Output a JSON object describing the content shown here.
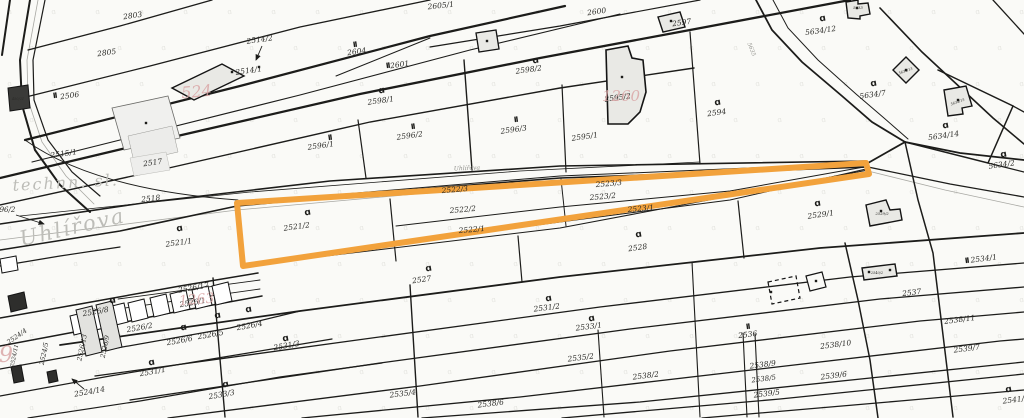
{
  "map": {
    "street_labels": [
      {
        "text": "Uhlířova",
        "x": 74,
        "y": 234,
        "size": 21,
        "rot": -13,
        "style": "major"
      },
      {
        "text": "technn. sl.",
        "x": 66,
        "y": 188,
        "size": 16,
        "rot": -3,
        "style": "major"
      },
      {
        "text": "Uhlířova",
        "x": 467,
        "y": 170,
        "size": 6,
        "rot": -2,
        "style": "minor"
      },
      {
        "text": "5635",
        "x": 750,
        "y": 50,
        "size": 5.5,
        "rot": 68,
        "style": "minor"
      }
    ],
    "house_numbers": [
      {
        "text": "524",
        "x": 197,
        "y": 97,
        "size": 16,
        "rot": -5
      },
      {
        "text": "1260",
        "x": 621,
        "y": 101,
        "size": 15,
        "rot": 0
      },
      {
        "text": "1263",
        "x": 197,
        "y": 304,
        "size": 14,
        "rot": -5
      },
      {
        "text": "9",
        "x": 6,
        "y": 362,
        "size": 22,
        "rot": 0
      }
    ],
    "parcel_labels": [
      {
        "t": "2803",
        "x": 133,
        "y": 18,
        "r": -8
      },
      {
        "t": "2805",
        "x": 107,
        "y": 55,
        "r": -8
      },
      {
        "t": "2506",
        "x": 70,
        "y": 98,
        "r": -8
      },
      {
        "t": "2514/2",
        "x": 260,
        "y": 42,
        "r": -8
      },
      {
        "t": "2514/1",
        "x": 249,
        "y": 73,
        "r": -8
      },
      {
        "t": "2515/1",
        "x": 64,
        "y": 156,
        "r": -8
      },
      {
        "t": "2517",
        "x": 153,
        "y": 165,
        "r": -8
      },
      {
        "t": "2518",
        "x": 151,
        "y": 201,
        "r": -6
      },
      {
        "t": "2605/1",
        "x": 441,
        "y": 8,
        "r": -6
      },
      {
        "t": "2600",
        "x": 597,
        "y": 14,
        "r": -8
      },
      {
        "t": "2597",
        "x": 682,
        "y": 25,
        "r": -8
      },
      {
        "t": "2604",
        "x": 357,
        "y": 54,
        "r": -8
      },
      {
        "t": "2601",
        "x": 400,
        "y": 67,
        "r": -8
      },
      {
        "t": "2598/2",
        "x": 529,
        "y": 72,
        "r": -8
      },
      {
        "t": "2598/1",
        "x": 381,
        "y": 103,
        "r": -8
      },
      {
        "t": "2595/2",
        "x": 618,
        "y": 100,
        "r": -8
      },
      {
        "t": "2595/1",
        "x": 585,
        "y": 139,
        "r": -8
      },
      {
        "t": "2596/3",
        "x": 514,
        "y": 132,
        "r": -8
      },
      {
        "t": "2596/2",
        "x": 410,
        "y": 138,
        "r": -8
      },
      {
        "t": "2596/1",
        "x": 321,
        "y": 148,
        "r": -8
      },
      {
        "t": "2594",
        "x": 717,
        "y": 115,
        "r": -8
      },
      {
        "t": "5634/12",
        "x": 821,
        "y": 33,
        "r": -8
      },
      {
        "t": "5634/7",
        "x": 873,
        "y": 97,
        "r": -8
      },
      {
        "t": "5634/14",
        "x": 944,
        "y": 138,
        "r": -8
      },
      {
        "t": "5634/2",
        "x": 1002,
        "y": 167,
        "r": -8
      },
      {
        "t": "2521/1",
        "x": 179,
        "y": 245,
        "r": -8
      },
      {
        "t": "2521/2",
        "x": 297,
        "y": 229,
        "r": -8
      },
      {
        "t": "2522/3",
        "x": 455,
        "y": 192,
        "r": -5
      },
      {
        "t": "2522/2",
        "x": 463,
        "y": 212,
        "r": -5
      },
      {
        "t": "2522/1",
        "x": 472,
        "y": 232,
        "r": -5
      },
      {
        "t": "2523/3",
        "x": 609,
        "y": 186,
        "r": -5
      },
      {
        "t": "2523/2",
        "x": 603,
        "y": 199,
        "r": -5
      },
      {
        "t": "2523/1",
        "x": 641,
        "y": 211,
        "r": -5
      },
      {
        "t": "2529/1",
        "x": 821,
        "y": 217,
        "r": -8
      },
      {
        "t": "2528",
        "x": 638,
        "y": 250,
        "r": -8
      },
      {
        "t": "2527",
        "x": 422,
        "y": 282,
        "r": -8
      },
      {
        "t": "2526/17",
        "x": 194,
        "y": 290,
        "r": -10
      },
      {
        "t": "2526/1",
        "x": 193,
        "y": 305,
        "r": -10
      },
      {
        "t": "2526/8",
        "x": 96,
        "y": 314,
        "r": -10
      },
      {
        "t": "2526/2",
        "x": 140,
        "y": 330,
        "r": -10
      },
      {
        "t": "2526/6",
        "x": 180,
        "y": 343,
        "r": -10
      },
      {
        "t": "2526/5",
        "x": 211,
        "y": 337,
        "r": -10
      },
      {
        "t": "2526/4",
        "x": 250,
        "y": 328,
        "r": -10
      },
      {
        "t": "2526/13",
        "x": 84,
        "y": 348,
        "r": -78,
        "s": 6.5
      },
      {
        "t": "2526/9",
        "x": 107,
        "y": 347,
        "r": -78,
        "s": 6.5
      },
      {
        "t": "2524/4",
        "x": 18,
        "y": 338,
        "r": -35,
        "s": 6.5
      },
      {
        "t": "2524/11",
        "x": 16,
        "y": 356,
        "r": -78,
        "s": 5.5
      },
      {
        "t": "2524/5",
        "x": 46,
        "y": 354,
        "r": -78,
        "s": 6.5
      },
      {
        "t": "2524/14",
        "x": 90,
        "y": 394,
        "r": -10
      },
      {
        "t": "2531/1",
        "x": 153,
        "y": 374,
        "r": -10
      },
      {
        "t": "2531/3",
        "x": 287,
        "y": 348,
        "r": -10
      },
      {
        "t": "2533/3",
        "x": 222,
        "y": 397,
        "r": -10
      },
      {
        "t": "2531/2",
        "x": 547,
        "y": 310,
        "r": -7
      },
      {
        "t": "2533/1",
        "x": 589,
        "y": 329,
        "r": -7
      },
      {
        "t": "2535/4",
        "x": 403,
        "y": 396,
        "r": -7
      },
      {
        "t": "2535/2",
        "x": 581,
        "y": 360,
        "r": -7
      },
      {
        "t": "2538/6",
        "x": 491,
        "y": 406,
        "r": -7
      },
      {
        "t": "2538/2",
        "x": 646,
        "y": 378,
        "r": -7
      },
      {
        "t": "2536",
        "x": 748,
        "y": 337,
        "r": -7
      },
      {
        "t": "2537",
        "x": 912,
        "y": 295,
        "r": -7
      },
      {
        "t": "2534/1",
        "x": 984,
        "y": 261,
        "r": -7
      },
      {
        "t": "2538/11",
        "x": 960,
        "y": 322,
        "r": -7
      },
      {
        "t": "2538/10",
        "x": 836,
        "y": 347,
        "r": -7
      },
      {
        "t": "2539/7",
        "x": 967,
        "y": 351,
        "r": -7
      },
      {
        "t": "2538/9",
        "x": 763,
        "y": 367,
        "r": -7
      },
      {
        "t": "2538/5",
        "x": 764,
        "y": 381,
        "r": -7,
        "s": 7
      },
      {
        "t": "2539/6",
        "x": 834,
        "y": 378,
        "r": -7
      },
      {
        "t": "2539/5",
        "x": 767,
        "y": 396,
        "r": -7
      },
      {
        "t": "2541/2",
        "x": 1016,
        "y": 402,
        "r": -7
      },
      {
        "t": "2596/2",
        "x": 3,
        "y": 212,
        "r": 0,
        "s": 7
      }
    ],
    "building_labels": [
      {
        "t": "5633",
        "x": 858,
        "y": 9,
        "s": 3.8
      },
      {
        "t": "5634/13",
        "x": 906,
        "y": 72,
        "s": 3.5,
        "r": -20
      },
      {
        "t": "5634/15",
        "x": 958,
        "y": 103,
        "s": 3.5,
        "r": -20
      },
      {
        "t": "2529/2",
        "x": 882,
        "y": 215,
        "s": 3.8
      },
      {
        "t": "2540/2",
        "x": 877,
        "y": 274,
        "s": 3.5
      },
      {
        "t": "450/21",
        "x": 18,
        "y": 100,
        "s": 3.5,
        "white": true
      }
    ],
    "symbols": {
      "landuse_glyph": "ɑ",
      "wall_glyph": "II",
      "hooks": [
        [
          536,
          63
        ],
        [
          382,
          93
        ],
        [
          718,
          105
        ],
        [
          823,
          21
        ],
        [
          874,
          86
        ],
        [
          946,
          128
        ],
        [
          1004,
          157
        ],
        [
          180,
          231
        ],
        [
          308,
          215
        ],
        [
          639,
          237
        ],
        [
          429,
          271
        ],
        [
          549,
          301
        ],
        [
          592,
          321
        ],
        [
          286,
          341
        ],
        [
          152,
          365
        ],
        [
          226,
          387
        ],
        [
          249,
          312
        ],
        [
          218,
          318
        ],
        [
          184,
          330
        ],
        [
          818,
          206
        ],
        [
          1009,
          392
        ],
        [
          113,
          303
        ]
      ],
      "walls": [
        [
          55,
          98
        ],
        [
          388,
          68
        ],
        [
          330,
          140
        ],
        [
          413,
          129
        ],
        [
          516,
          122
        ],
        [
          967,
          263
        ],
        [
          748,
          329
        ],
        [
          355,
          47
        ]
      ],
      "dots": [
        [
          146,
          123
        ],
        [
          232,
          72
        ],
        [
          622,
          77
        ],
        [
          671,
          21
        ],
        [
          857,
          8
        ],
        [
          906,
          70
        ],
        [
          958,
          100
        ],
        [
          881,
          211
        ],
        [
          869,
          272
        ],
        [
          890,
          270
        ],
        [
          487,
          41
        ],
        [
          259,
          67
        ],
        [
          816,
          281
        ],
        [
          771,
          292
        ]
      ]
    },
    "arrows": [
      {
        "x1": 16,
        "y1": 215,
        "x2": 44,
        "y2": 224
      },
      {
        "x1": 84,
        "y1": 389,
        "x2": 72,
        "y2": 379
      },
      {
        "x1": 262,
        "y1": 46,
        "x2": 256,
        "y2": 60
      }
    ],
    "highlight": {
      "color": "#F2A23C",
      "stroke_width": 6,
      "points": "237,203 866,163 869,174 243,266"
    },
    "colors": {
      "background": "#fafaf7",
      "line": "#1c1c1a",
      "building_fill": "#e9e9e5",
      "faint_symbol": "#d3d3cd",
      "street_text": "#bdbdb8",
      "pink": "#d9a3a3"
    }
  }
}
